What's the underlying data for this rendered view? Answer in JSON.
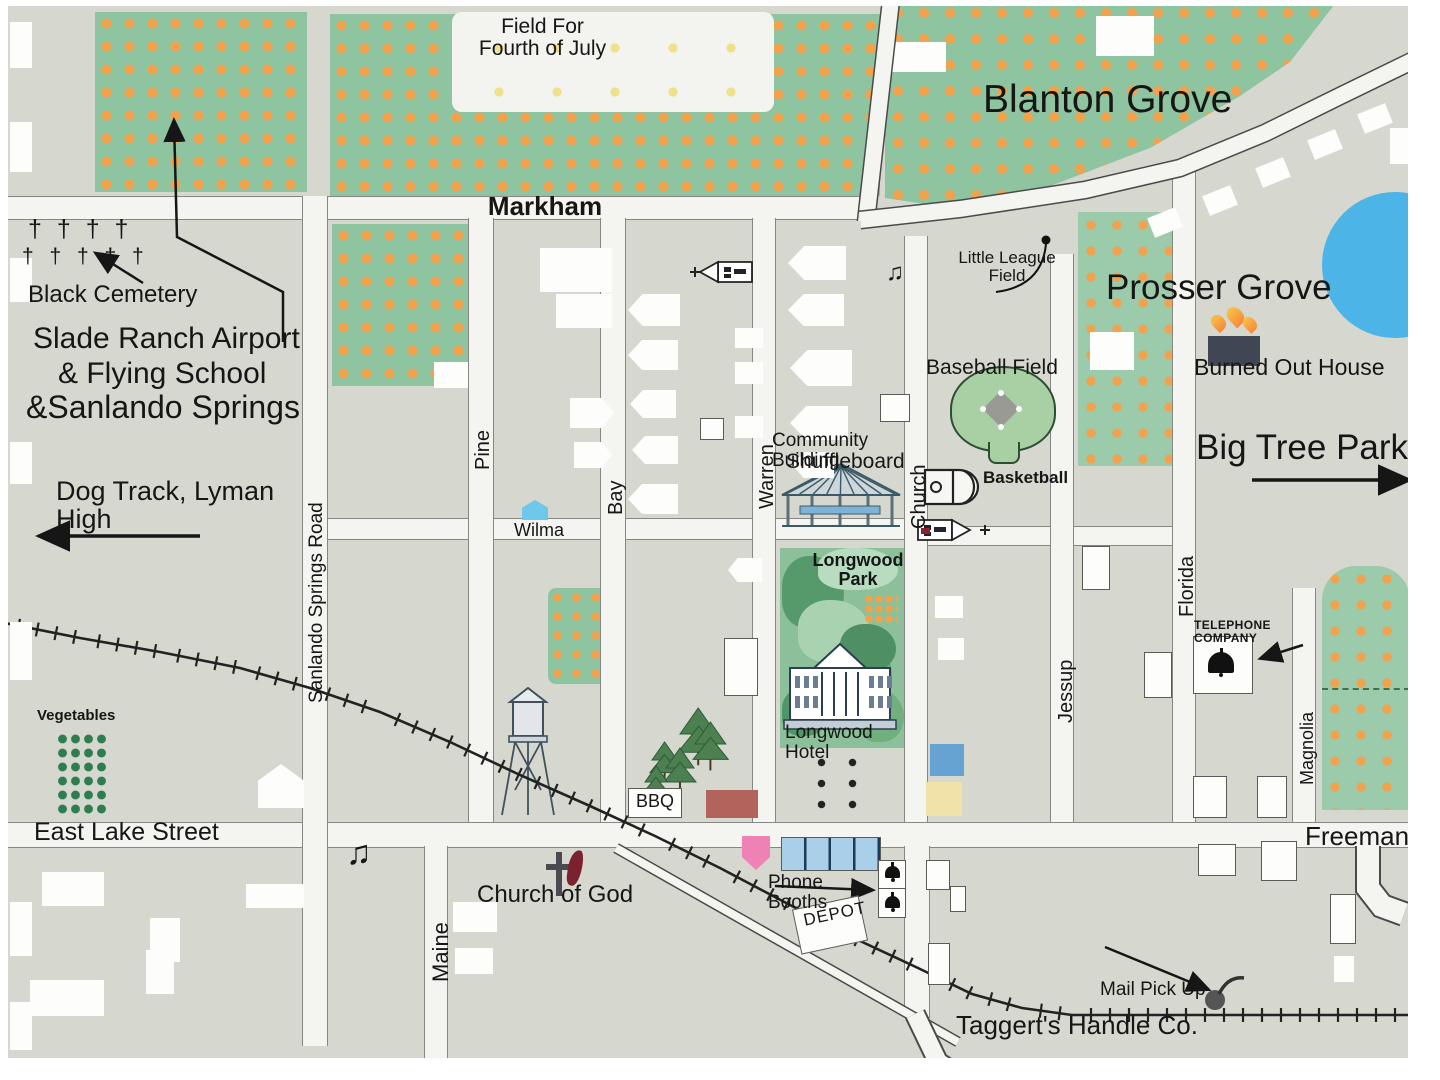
{
  "map_name": "Hand-drawn town map of Longwood area",
  "labels": {
    "markham": "Markham",
    "wilma": "Wilma",
    "east_lake": "East Lake Street",
    "freeman": "Freeman",
    "maine": "Maine",
    "pine": "Pine",
    "bay": "Bay",
    "warren": "Warren",
    "church": "Church",
    "jessup": "Jessup",
    "florida": "Florida",
    "magnolia": "Magnolia",
    "sanlando_road": "Sanlando Springs Road",
    "field_fourth": "Field For\nFourth of July",
    "blanton": "Blanton Grove",
    "little_league": "Little League\nField",
    "prosser": "Prosser Grove",
    "burned_house": "Burned Out House",
    "big_tree": "Big Tree Park",
    "baseball": "Baseball Field",
    "basketball": "Basketball",
    "community1": "Community Building",
    "community2": "Shuffleboard",
    "longwood_park": "Longwood\nPark",
    "longwood_hotel": "Longwood Hotel",
    "telephone": "TELEPHONE COMPANY",
    "black_cemetery": "Black Cemetery",
    "slade1": "Slade Ranch Airport",
    "slade2": "& Flying School",
    "slade3": "&Sanlando Springs",
    "dog_track": "Dog Track, Lyman High",
    "vegetables": "Vegetables",
    "bbq": "BBQ",
    "church_of_god": "Church of God",
    "phone_booths": "Phone Booths",
    "depot": "DEPOT",
    "mail_pickup": "Mail Pick Up",
    "taggerts": "Taggert's Handle Co."
  },
  "icons": {
    "cross_row1": "† † † †",
    "cross_row2": "† † † † †",
    "music_note": "♫"
  },
  "colors": {
    "paper": "#ffffff",
    "block": "#d6d8d0",
    "road": "#f4f4f1",
    "ink": "#161616",
    "grove_green": "#8fc4a0",
    "grove_green2": "#9bcbaa",
    "orange_dot": "#f2a24d",
    "pond_blue": "#4db4e7",
    "park_green": "#8cc09a",
    "park_green_dark": "#4f9768",
    "field_green": "#a9cfa4",
    "red_building": "#b2635c",
    "pink_building": "#ee82b4",
    "blue_building": "#66a3d2",
    "lightblue_building": "#a9cfe9",
    "yellow_building": "#f1e2a7",
    "cyan_building": "#6ec8ea",
    "burned_house": "#414654",
    "flame_orange": "#f58a3c",
    "maroon": "#7a2230",
    "vegetable_green": "#2e7d4f",
    "rail": "#222222"
  }
}
